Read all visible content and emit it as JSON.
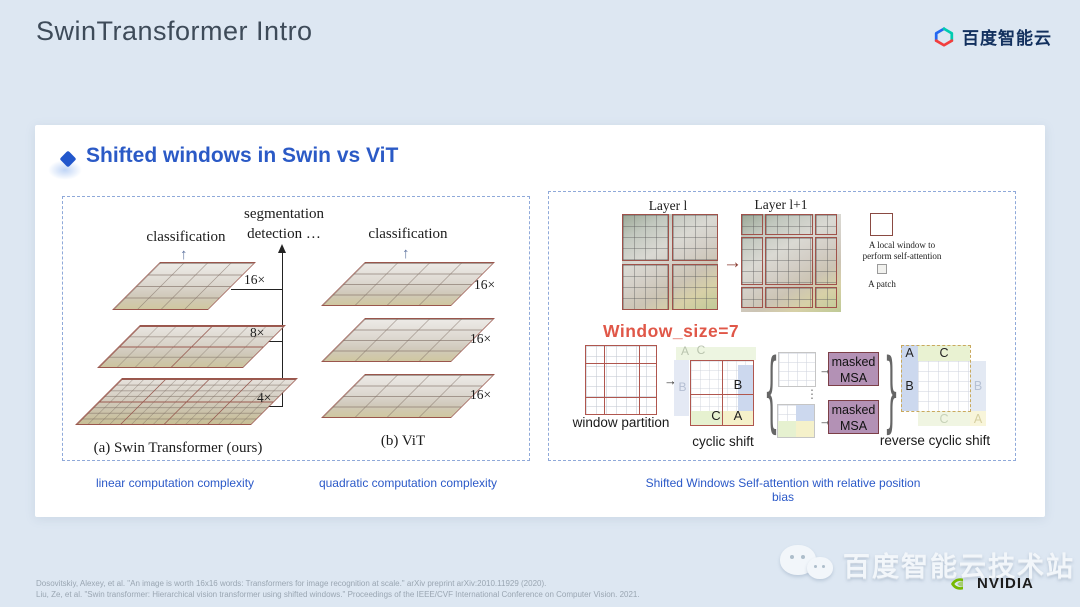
{
  "page": {
    "title": "SwinTransformer Intro"
  },
  "brand": {
    "name": "百度智能云"
  },
  "icons": {
    "arrow_up": "↑",
    "arrow_right": "→",
    "brace_left": "{",
    "brace_right": "}",
    "dots": "⋮"
  },
  "slide": {
    "heading": "Shifted windows in Swin vs ViT",
    "figure_a": {
      "classification": "classification",
      "segmentation": "segmentation",
      "detection": "detection …",
      "scales": [
        "16×",
        "8×",
        "4×"
      ],
      "caption": "(a) Swin Transformer (ours)"
    },
    "figure_b": {
      "classification": "classification",
      "scale": "16×",
      "caption": "(b) ViT"
    },
    "figure_c": {
      "layer_l": "Layer l",
      "layer_l1": "Layer l+1",
      "legend_window_1": "A local window to",
      "legend_window_2": "perform self-attention",
      "legend_patch": "A patch",
      "window_size": "Window_size=7",
      "window_partition": "window partition",
      "cyclic_shift": "cyclic shift",
      "reverse_cyclic_shift": "reverse cyclic shift",
      "masked_1": "masked",
      "masked_2": "MSA",
      "cell_a": "A",
      "cell_b": "B",
      "cell_c": "C"
    },
    "captions": {
      "left": "linear computation complexity",
      "middle": "quadratic computation complexity",
      "right": "Shifted Windows Self-attention with relative position bias"
    }
  },
  "footer": {
    "citation_1": "Dosovitskiy, Alexey, et al. \"An image is worth 16x16 words: Transformers for image recognition at scale.\" arXiv preprint arXiv:2010.11929 (2020).",
    "citation_2": "Liu, Ze, et al. \"Swin transformer: Hierarchical vision transformer using shifted windows.\" Proceedings of the IEEE/CVF International Conference on Computer Vision. 2021.",
    "wechat": "百度智能云技术站",
    "nvidia": "NVIDIA"
  },
  "colors": {
    "background": "#dde7f2",
    "accent_blue": "#2b5ac6",
    "window_size_red": "#e05748",
    "figure_line_red": "#9a564c",
    "masked_msa_purple": "#b391b5",
    "nvidia_green": "#76b900"
  }
}
